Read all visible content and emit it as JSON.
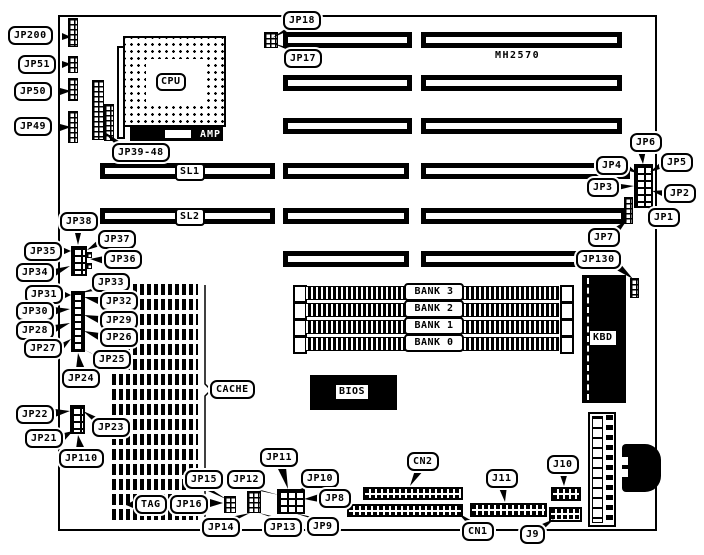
{
  "board": {
    "model_number": "MH2570"
  },
  "components": {
    "cpu": "CPU",
    "amp": "AMP",
    "sl1": "SL1",
    "sl2": "SL2",
    "bank3": "BANK 3",
    "bank2": "BANK 2",
    "bank1": "BANK 1",
    "bank0": "BANK 0",
    "bios": "BIOS",
    "kbd": "KBD"
  },
  "callouts": {
    "jp200": "JP200",
    "jp51": "JP51",
    "jp50": "JP50",
    "jp49": "JP49",
    "jp39_48": "JP39-48",
    "jp18": "JP18",
    "jp17": "JP17",
    "jp6": "JP6",
    "jp5": "JP5",
    "jp4": "JP4",
    "jp3": "JP3",
    "jp2": "JP2",
    "jp1": "JP1",
    "jp7": "JP7",
    "jp130": "JP130",
    "jp38": "JP38",
    "jp37": "JP37",
    "jp36": "JP36",
    "jp35": "JP35",
    "jp34": "JP34",
    "jp33": "JP33",
    "jp32": "JP32",
    "jp31": "JP31",
    "jp30": "JP30",
    "jp29": "JP29",
    "jp28": "JP28",
    "jp27": "JP27",
    "jp26": "JP26",
    "jp25": "JP25",
    "jp24": "JP24",
    "jp23": "JP23",
    "jp22": "JP22",
    "jp21": "JP21",
    "jp110": "JP110",
    "tag": "TAG",
    "cache": "CACHE",
    "jp16": "JP16",
    "jp15": "JP15",
    "jp14": "JP14",
    "jp13": "JP13",
    "jp12": "JP12",
    "jp11": "JP11",
    "jp10": "JP10",
    "jp9": "JP9",
    "jp8": "JP8",
    "cn2": "CN2",
    "cn1": "CN1",
    "j11": "J11",
    "j10": "J10",
    "j9": "J9"
  },
  "colors": {
    "ink": "#000000",
    "paper": "#ffffff"
  }
}
